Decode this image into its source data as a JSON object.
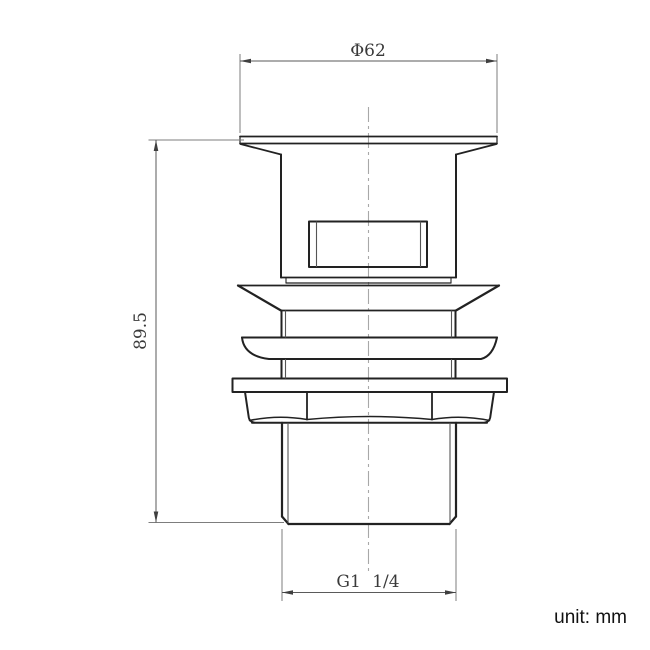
{
  "title": "Basin waste drain fitting technical drawing",
  "unit_label": "unit: mm",
  "dimensions": {
    "cap_diameter": "Φ62",
    "overall_height": "89.5",
    "thread_size": "G1 1/4"
  },
  "colors": {
    "background": "#ffffff",
    "outline": "#222222",
    "thin_line": "#555555",
    "dimension_line": "#5a5a5a",
    "extension_line": "#7d7d7d",
    "arrow_fill": "#3f3f3f",
    "centerline": "#a8a8a8",
    "dimension_text": "#3a3a3a",
    "unit_text": "#111111"
  }
}
